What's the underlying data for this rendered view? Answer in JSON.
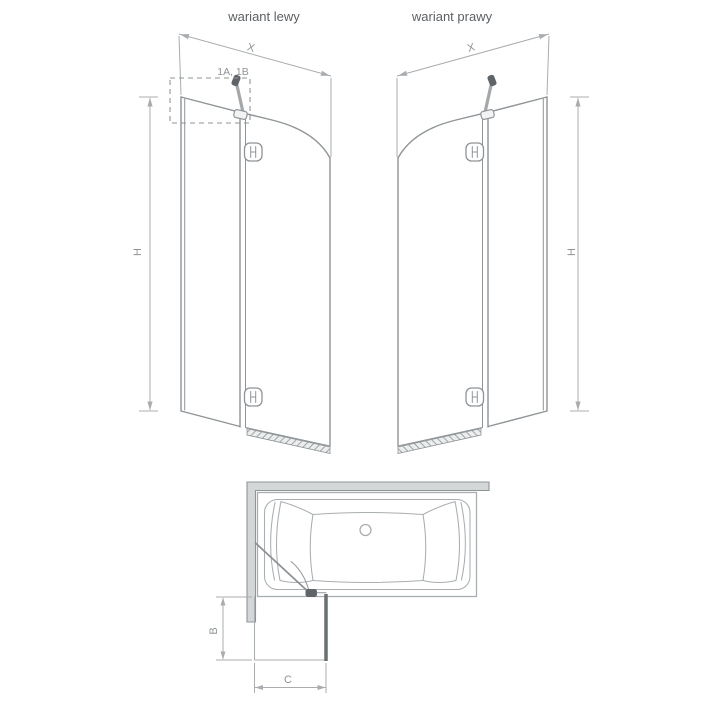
{
  "titles": {
    "left": "wariant lewy",
    "right": "wariant prawy"
  },
  "labels": {
    "width": "X",
    "height": "H",
    "hinge_parts": "1A, 1B",
    "depth": "B",
    "door_width": "C"
  },
  "colors": {
    "line": "#8f9497",
    "dim": "#a9adb0",
    "dark": "#5f6468",
    "wall_fill": "#d4d7d8",
    "tub_line": "#a9aeb1",
    "text_primary": "#5d6164",
    "text_dim": "#8f9497"
  }
}
